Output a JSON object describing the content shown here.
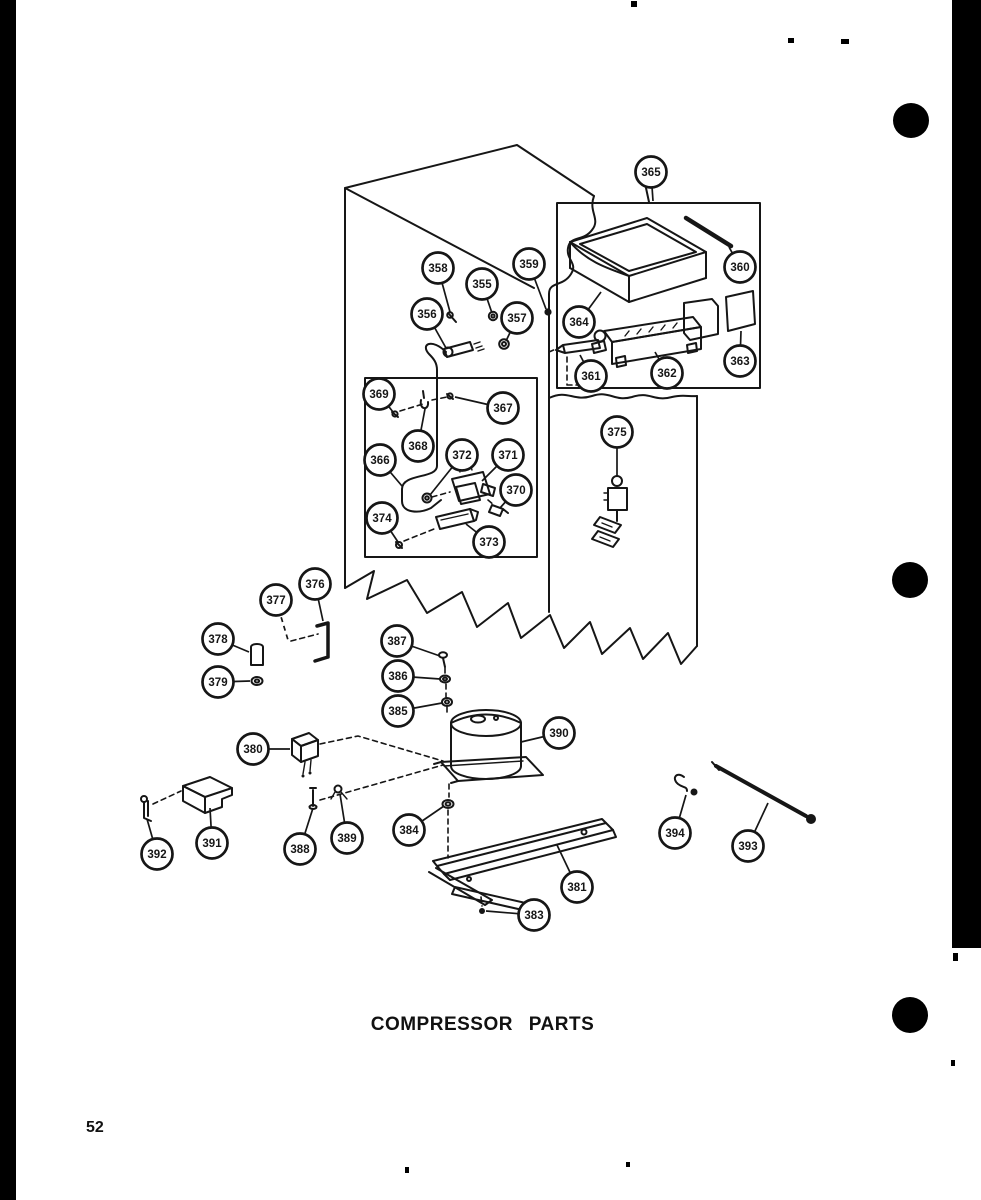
{
  "page": {
    "title": "COMPRESSOR PARTS",
    "page_number": "52"
  },
  "diagram": {
    "ink_color": "#161616",
    "background_color": "#ffffff",
    "callouts": [
      {
        "label": "355",
        "x": 482,
        "y": 284,
        "lx": 492,
        "ly": 313
      },
      {
        "label": "356",
        "x": 427,
        "y": 314,
        "lx": 446,
        "ly": 348
      },
      {
        "label": "357",
        "x": 517,
        "y": 318,
        "lx": 506,
        "ly": 341
      },
      {
        "label": "358",
        "x": 438,
        "y": 268,
        "lx": 450,
        "ly": 312
      },
      {
        "label": "359",
        "x": 529,
        "y": 264,
        "lx": 546,
        "ly": 309
      },
      {
        "label": "360",
        "x": 740,
        "y": 267,
        "lx": 729,
        "ly": 247
      },
      {
        "label": "361",
        "x": 591,
        "y": 376,
        "lx": 580,
        "ly": 355
      },
      {
        "label": "362",
        "x": 667,
        "y": 373,
        "lx": 655,
        "ly": 352
      },
      {
        "label": "363",
        "x": 740,
        "y": 361,
        "lx": 741,
        "ly": 331
      },
      {
        "label": "364",
        "x": 579,
        "y": 322,
        "lx": 601,
        "ly": 292
      },
      {
        "label": "365",
        "x": 651,
        "y": 172,
        "lx": 653,
        "ly": 201
      },
      {
        "label": "366",
        "x": 380,
        "y": 460,
        "lx": 402,
        "ly": 486
      },
      {
        "label": "367",
        "x": 503,
        "y": 408,
        "lx": 455,
        "ly": 397
      },
      {
        "label": "368",
        "x": 418,
        "y": 446,
        "lx": 425,
        "ly": 409
      },
      {
        "label": "369",
        "x": 379,
        "y": 394,
        "lx": 393,
        "ly": 412
      },
      {
        "label": "370",
        "x": 516,
        "y": 490,
        "lx": 500,
        "ly": 508
      },
      {
        "label": "371",
        "x": 508,
        "y": 455,
        "lx": 482,
        "ly": 481
      },
      {
        "label": "372",
        "x": 462,
        "y": 455,
        "lx": 430,
        "ly": 495
      },
      {
        "label": "373",
        "x": 489,
        "y": 542,
        "lx": 466,
        "ly": 524
      },
      {
        "label": "374",
        "x": 382,
        "y": 518,
        "lx": 398,
        "ly": 542
      },
      {
        "label": "375",
        "x": 617,
        "y": 432,
        "lx": 617,
        "ly": 477
      },
      {
        "label": "376",
        "x": 315,
        "y": 584,
        "lx": 323,
        "ly": 621
      },
      {
        "label": "377",
        "x": 276,
        "y": 600,
        "lx": 288,
        "ly": 640,
        "dashed": true
      },
      {
        "label": "378",
        "x": 218,
        "y": 639,
        "lx": 249,
        "ly": 652
      },
      {
        "label": "379",
        "x": 218,
        "y": 682,
        "lx": 250,
        "ly": 681
      },
      {
        "label": "380",
        "x": 253,
        "y": 749,
        "lx": 290,
        "ly": 749
      },
      {
        "label": "381",
        "x": 577,
        "y": 887,
        "lx": 557,
        "ly": 845
      },
      {
        "label": "383",
        "x": 534,
        "y": 915,
        "lx": 486,
        "ly": 911
      },
      {
        "label": "384",
        "x": 409,
        "y": 830,
        "lx": 444,
        "ly": 806
      },
      {
        "label": "385",
        "x": 398,
        "y": 711,
        "lx": 442,
        "ly": 703
      },
      {
        "label": "386",
        "x": 398,
        "y": 676,
        "lx": 440,
        "ly": 679
      },
      {
        "label": "387",
        "x": 397,
        "y": 641,
        "lx": 440,
        "ly": 656
      },
      {
        "label": "388",
        "x": 300,
        "y": 849,
        "lx": 313,
        "ly": 808
      },
      {
        "label": "389",
        "x": 347,
        "y": 838,
        "lx": 340,
        "ly": 794
      },
      {
        "label": "390",
        "x": 559,
        "y": 733,
        "lx": 521,
        "ly": 742
      },
      {
        "label": "391",
        "x": 212,
        "y": 843,
        "lx": 210,
        "ly": 808
      },
      {
        "label": "392",
        "x": 157,
        "y": 854,
        "lx": 147,
        "ly": 819
      },
      {
        "label": "393",
        "x": 748,
        "y": 846,
        "lx": 768,
        "ly": 803
      },
      {
        "label": "394",
        "x": 675,
        "y": 833,
        "lx": 686,
        "ly": 795
      }
    ]
  }
}
